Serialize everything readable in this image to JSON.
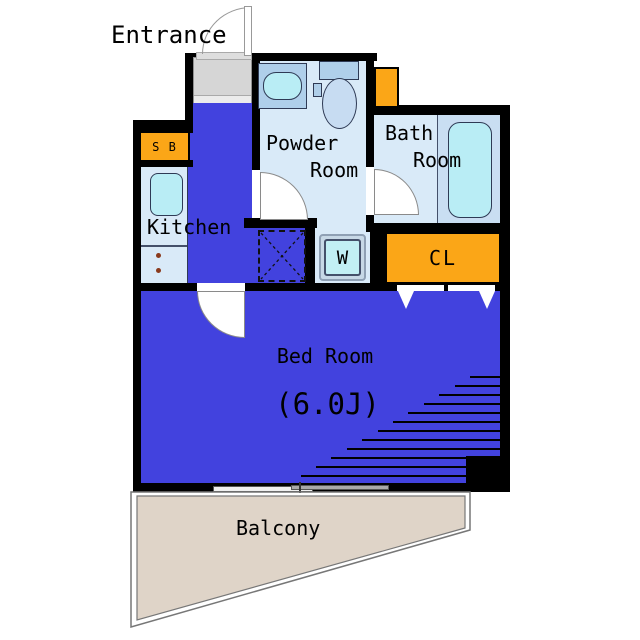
{
  "floorplan": {
    "rooms": {
      "entrance": {
        "label": "Entrance"
      },
      "shoe_box": {
        "label": "S B"
      },
      "kitchen": {
        "label": "Kitchen"
      },
      "powder_room": {
        "label_line1": "Powder",
        "label_line2": "Room"
      },
      "bath_room": {
        "label_line1": "Bath",
        "label_line2": "Room"
      },
      "washer": {
        "label": "W"
      },
      "closet": {
        "label": "CL"
      },
      "bedroom": {
        "label": "Bed Room",
        "size": "(6.0J)"
      },
      "balcony": {
        "label": "Balcony"
      }
    },
    "colors": {
      "room_blue": "#4242DE",
      "light_blue": "#D9EAF8",
      "bath_panel_blue": "#C9DEF2",
      "fixture_cyan": "#B9EDF5",
      "furniture_blue": "#AFCFEA",
      "accent_orange": "#FBA617",
      "balcony_beige": "#DFD4C8",
      "entrance_gray": "#D6D6D6",
      "wall_black": "#000000"
    }
  }
}
